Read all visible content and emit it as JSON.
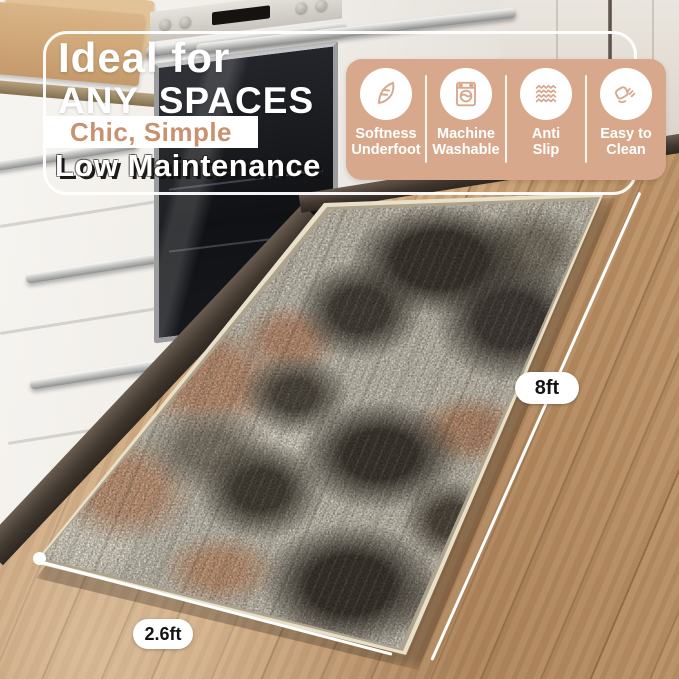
{
  "header": {
    "title_line1": "Ideal for",
    "title_line2": "ANY SPACES",
    "subtitle": "Chic, Simple",
    "tagline": "Low Maintenance"
  },
  "features": [
    {
      "icon": "feather-icon",
      "line1": "Softness",
      "line2": "Underfoot"
    },
    {
      "icon": "washing-machine-icon",
      "line1": "Machine",
      "line2": "Washable"
    },
    {
      "icon": "anti-slip-icon",
      "line1": "Anti",
      "line2": "Slip"
    },
    {
      "icon": "hand-wipe-icon",
      "line1": "Easy to",
      "line2": "Clean"
    }
  ],
  "dimensions": {
    "length": "8ft",
    "width": "2.6ft"
  },
  "colors": {
    "panel": "#d8a88c",
    "subtitle_text": "#c9926f",
    "frame_line": "#ffffff"
  }
}
